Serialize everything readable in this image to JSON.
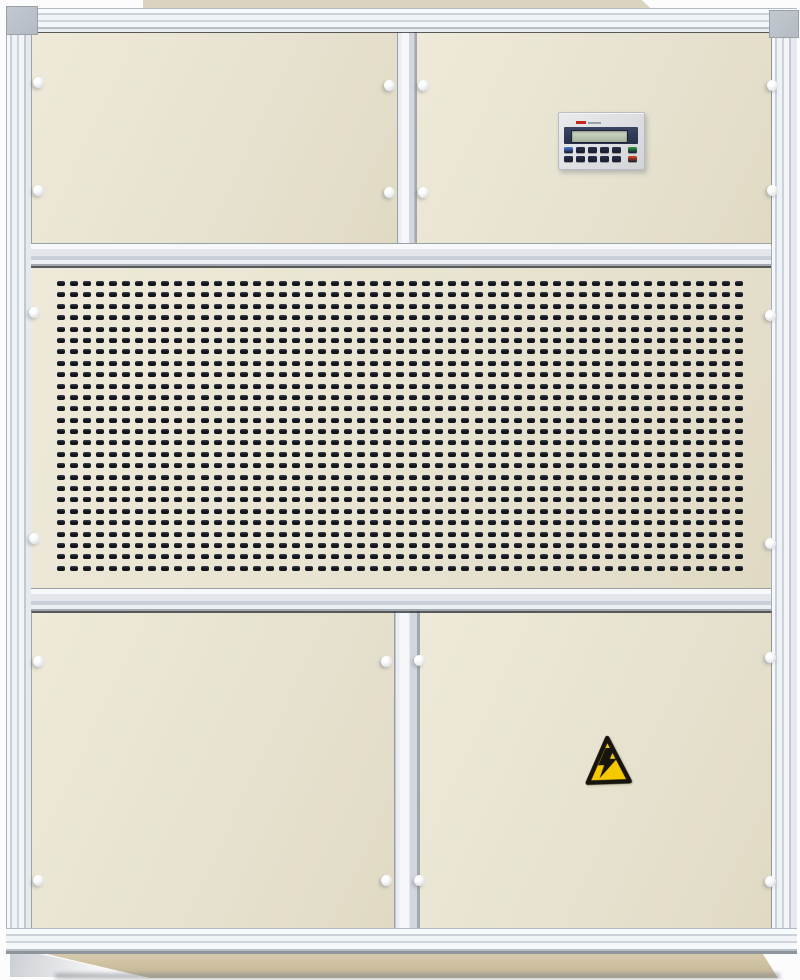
{
  "scene": {
    "description": "Photograph of a beige industrial air-handling / dehumidifier cabinet: aluminium extrusion frame with corner caps, two upper electrical panels (right one carries an LCD controller keypad), a large perforated intake grille band across the middle, two lower access doors (right one carries a yellow high-voltage warning triangle), aluminium base rail and recessed beige plinth.",
    "background": "#fcfcfd"
  },
  "colors": {
    "panel": "#e7e2d0",
    "panel-hi": "#eee9d8",
    "panel-lo": "#e0dac4",
    "lid": "#d9d3bf",
    "cap": "#b5bbc3",
    "slot": "#12151c",
    "slot-top": "#3a4252",
    "band": "#2f3a57",
    "lcd-hi": "#d2dcc9",
    "lcd-lo": "#a8b49e",
    "brand-red": "#c8281c",
    "brand-gray": "#99a0a8",
    "warn-yellow": "#f6c800",
    "warn-border": "#17140e",
    "base-hi": "#d6cbae",
    "base-lo": "#c3b694",
    "shadow": "#83888f",
    "screw-hi": "#ffffff",
    "screw-lo": "#cdd0d4"
  },
  "cabinet": {
    "sections": [
      "upper-electrical-panels",
      "perforated-intake-grille",
      "lower-access-doors"
    ],
    "screws": [
      {
        "x": 38,
        "y": 82
      },
      {
        "x": 389,
        "y": 85
      },
      {
        "x": 423,
        "y": 85
      },
      {
        "x": 772,
        "y": 85
      },
      {
        "x": 38,
        "y": 190
      },
      {
        "x": 389,
        "y": 192
      },
      {
        "x": 423,
        "y": 192
      },
      {
        "x": 772,
        "y": 190
      },
      {
        "x": 34,
        "y": 312
      },
      {
        "x": 770,
        "y": 315
      },
      {
        "x": 34,
        "y": 538
      },
      {
        "x": 770,
        "y": 543
      },
      {
        "x": 38,
        "y": 661
      },
      {
        "x": 386,
        "y": 661
      },
      {
        "x": 419,
        "y": 660
      },
      {
        "x": 770,
        "y": 657
      },
      {
        "x": 38,
        "y": 880
      },
      {
        "x": 386,
        "y": 880
      },
      {
        "x": 419,
        "y": 880
      },
      {
        "x": 770,
        "y": 881
      }
    ]
  },
  "grille": {
    "rows": 26,
    "cols": 53
  },
  "control_panel": {
    "display_text": "",
    "brand_mark": "small red logotype (illegible at capture resolution)",
    "button_rows": [
      [
        "#4f7ae0",
        "#272e49",
        "#272e49",
        "#272e49",
        "#272e49",
        "#2e9e47"
      ],
      [
        "#272e49",
        "#272e49",
        "#272e49",
        "#272e49",
        "#272e49",
        "#df4a1d"
      ]
    ]
  },
  "warning_label": {
    "shape": "triangle",
    "symbol": "high-voltage-lightning-bolt"
  }
}
